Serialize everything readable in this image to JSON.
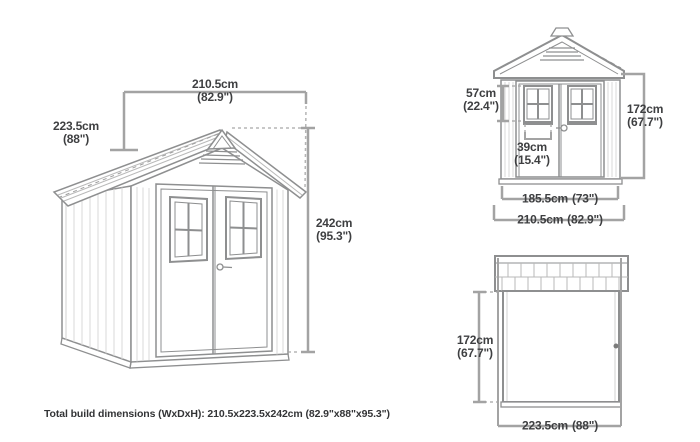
{
  "page": {
    "background": "#ffffff"
  },
  "caption": "Total build dimensions (WxDxH): 210.5x223.5x242cm (82.9\"x88\"x95.3\")",
  "colors": {
    "dimension_line": "#a3a3a3",
    "label_text": "#3e3f41",
    "drawing_outline": "#8e8f90"
  },
  "dimensions": {
    "iso_width": {
      "cm": "210.5cm",
      "inch": "(82.9\")"
    },
    "iso_depth": {
      "cm": "223.5cm",
      "inch": "(88\")"
    },
    "iso_height": {
      "cm": "242cm",
      "inch": "(95.3\")"
    },
    "front_window_height": {
      "cm": "57cm",
      "inch": "(22.4\")"
    },
    "front_window_width": {
      "cm": "39cm",
      "inch": "(15.4\")"
    },
    "front_door_height": {
      "cm": "172cm",
      "inch": "(67.7\")"
    },
    "front_inner_width": {
      "cm": "185.5cm",
      "inch": "(73\")"
    },
    "front_overall_width": {
      "cm": "210.5cm",
      "inch": "(82.9\")"
    },
    "side_wall_height": {
      "cm": "172cm",
      "inch": "(67.7\")"
    },
    "side_overall_depth": {
      "cm": "223.5cm",
      "inch": "(88\")"
    }
  }
}
